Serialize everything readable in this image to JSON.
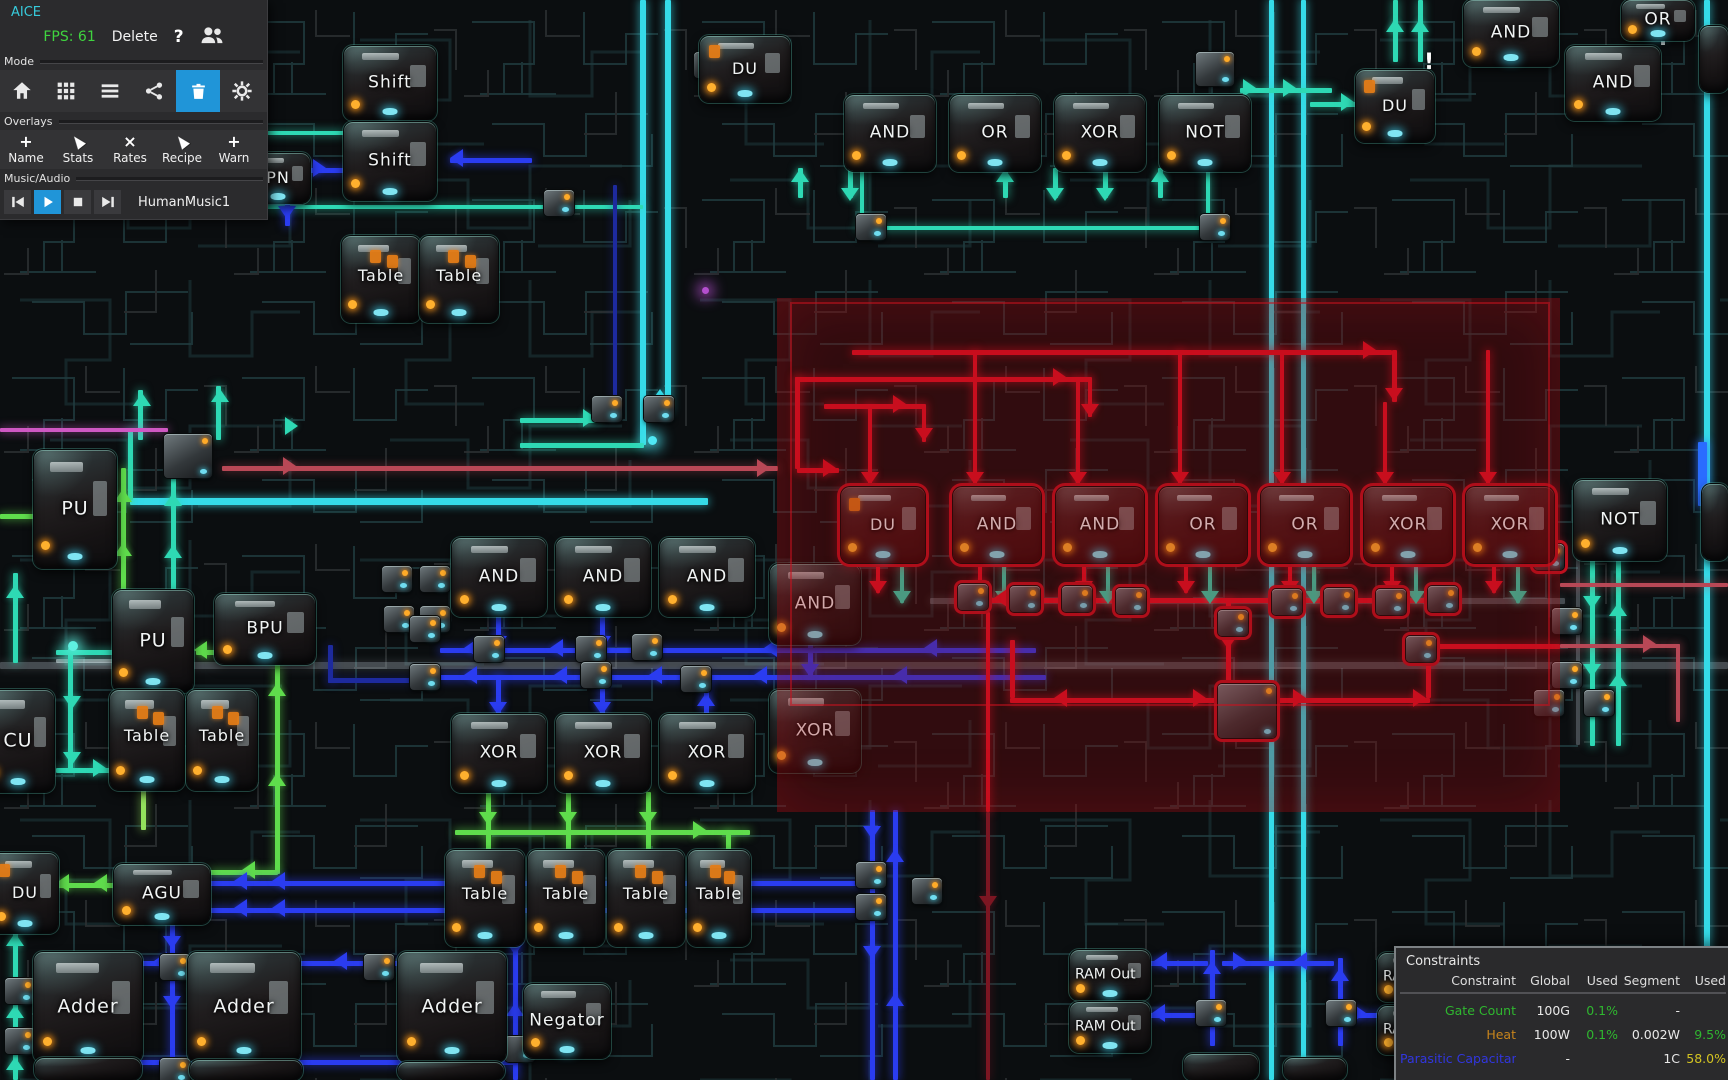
{
  "app": {
    "title": "AICE",
    "fps": "FPS: 61",
    "delete_label": "Delete",
    "help_icon": "?",
    "mode_label": "Mode",
    "mode_tools": [
      {
        "icon": "home",
        "active": false
      },
      {
        "icon": "grid",
        "active": false
      },
      {
        "icon": "menu",
        "active": false
      },
      {
        "icon": "share",
        "active": false
      },
      {
        "icon": "trash",
        "active": true
      },
      {
        "icon": "settings",
        "active": false
      }
    ],
    "overlays_label": "Overlays",
    "overlay_items": [
      {
        "icon": "plus",
        "label": "Name"
      },
      {
        "icon": "cursor",
        "label": "Stats"
      },
      {
        "icon": "x",
        "label": "Rates"
      },
      {
        "icon": "cursor",
        "label": "Recipe"
      },
      {
        "icon": "plus",
        "label": "Warn"
      }
    ],
    "music_label": "Music/Audio",
    "track": "HumanMusic1"
  },
  "constraints": {
    "title": "Constraints",
    "headers": [
      "Constraint",
      "Global",
      "Used",
      "Segment",
      "Used"
    ],
    "rows": [
      {
        "name": "Gate Count",
        "name_color": "green",
        "global": "100G",
        "used": "0.1%",
        "used_color": "green",
        "segment": "-",
        "seg_used": "",
        "seg_used_color": "white"
      },
      {
        "name": "Heat",
        "name_color": "orange",
        "global": "100W",
        "used": "0.1%",
        "used_color": "green",
        "segment": "0.002W",
        "seg_used": "9.5%",
        "seg_used_color": "green"
      },
      {
        "name": "Parasitic Capacitance",
        "name_color": "blue",
        "global": "-",
        "used": "",
        "used_color": "white",
        "segment": "1C",
        "seg_used": "58.0%",
        "seg_used_color": "yellow"
      }
    ]
  },
  "circuit": {
    "warning_glyph": "!",
    "gates": [
      {
        "label": "Shift",
        "x": 344,
        "y": 46,
        "w": 92,
        "h": 74,
        "v": ""
      },
      {
        "label": "Shift",
        "x": 344,
        "y": 122,
        "w": 92,
        "h": 78,
        "v": ""
      },
      {
        "label": "PN",
        "x": 246,
        "y": 153,
        "w": 64,
        "h": 50,
        "v": "du"
      },
      {
        "label": "Table",
        "x": 342,
        "y": 236,
        "w": 78,
        "h": 86,
        "v": "table"
      },
      {
        "label": "Table",
        "x": 420,
        "y": 236,
        "w": 78,
        "h": 86,
        "v": "table"
      },
      {
        "label": "DU",
        "x": 700,
        "y": 36,
        "w": 90,
        "h": 66,
        "v": "du"
      },
      {
        "label": "AND",
        "x": 845,
        "y": 95,
        "w": 90,
        "h": 76,
        "v": ""
      },
      {
        "label": "OR",
        "x": 950,
        "y": 95,
        "w": 90,
        "h": 76,
        "v": ""
      },
      {
        "label": "XOR",
        "x": 1055,
        "y": 95,
        "w": 90,
        "h": 76,
        "v": ""
      },
      {
        "label": "NOT",
        "x": 1160,
        "y": 95,
        "w": 90,
        "h": 76,
        "v": ""
      },
      {
        "label": "DU",
        "x": 1356,
        "y": 70,
        "w": 78,
        "h": 72,
        "v": "du"
      },
      {
        "label": "AND",
        "x": 1464,
        "y": 0,
        "w": 94,
        "h": 66,
        "v": ""
      },
      {
        "label": "AND",
        "x": 1566,
        "y": 46,
        "w": 94,
        "h": 74,
        "v": ""
      },
      {
        "label": "OR",
        "x": 1622,
        "y": 0,
        "w": 72,
        "h": 40,
        "v": ""
      },
      {
        "label": "PU",
        "x": 34,
        "y": 450,
        "w": 82,
        "h": 118,
        "v": "big"
      },
      {
        "label": "PU",
        "x": 113,
        "y": 590,
        "w": 80,
        "h": 102,
        "v": "big"
      },
      {
        "label": "BPU",
        "x": 215,
        "y": 594,
        "w": 100,
        "h": 70,
        "v": ""
      },
      {
        "label": "CU",
        "x": -18,
        "y": 690,
        "w": 72,
        "h": 102,
        "v": "big"
      },
      {
        "label": "Table",
        "x": 110,
        "y": 690,
        "w": 74,
        "h": 100,
        "v": "table"
      },
      {
        "label": "Table",
        "x": 187,
        "y": 690,
        "w": 70,
        "h": 100,
        "v": "table"
      },
      {
        "label": "AND",
        "x": 452,
        "y": 538,
        "w": 94,
        "h": 78,
        "v": ""
      },
      {
        "label": "AND",
        "x": 556,
        "y": 538,
        "w": 94,
        "h": 78,
        "v": ""
      },
      {
        "label": "AND",
        "x": 660,
        "y": 538,
        "w": 94,
        "h": 78,
        "v": ""
      },
      {
        "label": "AND",
        "x": 770,
        "y": 564,
        "w": 90,
        "h": 80,
        "v": ""
      },
      {
        "label": "XOR",
        "x": 452,
        "y": 714,
        "w": 94,
        "h": 78,
        "v": ""
      },
      {
        "label": "XOR",
        "x": 556,
        "y": 714,
        "w": 94,
        "h": 78,
        "v": ""
      },
      {
        "label": "XOR",
        "x": 660,
        "y": 714,
        "w": 94,
        "h": 78,
        "v": ""
      },
      {
        "label": "XOR",
        "x": 770,
        "y": 690,
        "w": 90,
        "h": 82,
        "v": ""
      },
      {
        "label": "DU",
        "x": 841,
        "y": 487,
        "w": 84,
        "h": 76,
        "v": "du sel"
      },
      {
        "label": "AND",
        "x": 953,
        "y": 487,
        "w": 88,
        "h": 76,
        "v": "sel"
      },
      {
        "label": "AND",
        "x": 1056,
        "y": 487,
        "w": 88,
        "h": 76,
        "v": "sel"
      },
      {
        "label": "OR",
        "x": 1159,
        "y": 487,
        "w": 88,
        "h": 76,
        "v": "sel"
      },
      {
        "label": "OR",
        "x": 1261,
        "y": 487,
        "w": 88,
        "h": 76,
        "v": "sel"
      },
      {
        "label": "XOR",
        "x": 1364,
        "y": 487,
        "w": 88,
        "h": 76,
        "v": "sel"
      },
      {
        "label": "XOR",
        "x": 1466,
        "y": 487,
        "w": 88,
        "h": 76,
        "v": "sel"
      },
      {
        "label": "NOT",
        "x": 1574,
        "y": 480,
        "w": 92,
        "h": 80,
        "v": ""
      },
      {
        "label": "DU",
        "x": -8,
        "y": 853,
        "w": 66,
        "h": 80,
        "v": "du"
      },
      {
        "label": "AGU",
        "x": 114,
        "y": 864,
        "w": 96,
        "h": 60,
        "v": ""
      },
      {
        "label": "Table",
        "x": 446,
        "y": 850,
        "w": 78,
        "h": 96,
        "v": "table"
      },
      {
        "label": "Table",
        "x": 528,
        "y": 850,
        "w": 76,
        "h": 96,
        "v": "table"
      },
      {
        "label": "Table",
        "x": 608,
        "y": 850,
        "w": 76,
        "h": 96,
        "v": "table"
      },
      {
        "label": "Table",
        "x": 688,
        "y": 850,
        "w": 62,
        "h": 96,
        "v": "table"
      },
      {
        "label": "Adder",
        "x": 34,
        "y": 952,
        "w": 108,
        "h": 110,
        "v": "big"
      },
      {
        "label": "Adder",
        "x": 188,
        "y": 952,
        "w": 112,
        "h": 110,
        "v": "big"
      },
      {
        "label": "Adder",
        "x": 398,
        "y": 952,
        "w": 108,
        "h": 110,
        "v": "big"
      },
      {
        "label": "Negator",
        "x": 524,
        "y": 984,
        "w": 86,
        "h": 74,
        "v": ""
      },
      {
        "label": "RAM Out",
        "x": 1070,
        "y": 950,
        "w": 80,
        "h": 50,
        "v": "ram"
      },
      {
        "label": "RAM Out",
        "x": 1070,
        "y": 1002,
        "w": 80,
        "h": 50,
        "v": "ram"
      },
      {
        "label": "RAM Out",
        "x": 1378,
        "y": 953,
        "w": 76,
        "h": 48,
        "v": "ram"
      },
      {
        "label": "RAM Out",
        "x": 1378,
        "y": 1006,
        "w": 76,
        "h": 48,
        "v": "ram"
      },
      {
        "label": "",
        "x": 35,
        "y": 1058,
        "w": 106,
        "h": 22,
        "v": "sliver"
      },
      {
        "label": "",
        "x": 190,
        "y": 1060,
        "w": 112,
        "h": 20,
        "v": "sliver"
      },
      {
        "label": "",
        "x": 398,
        "y": 1062,
        "w": 106,
        "h": 18,
        "v": "sliver"
      },
      {
        "label": "",
        "x": 1184,
        "y": 1054,
        "w": 74,
        "h": 26,
        "v": "sliver"
      },
      {
        "label": "",
        "x": 1284,
        "y": 1058,
        "w": 62,
        "h": 22,
        "v": "sliver"
      },
      {
        "label": "",
        "x": 1700,
        "y": 26,
        "w": 28,
        "h": 66,
        "v": "sliver"
      },
      {
        "label": "",
        "x": 1702,
        "y": 484,
        "w": 26,
        "h": 76,
        "v": "sliver"
      }
    ]
  }
}
